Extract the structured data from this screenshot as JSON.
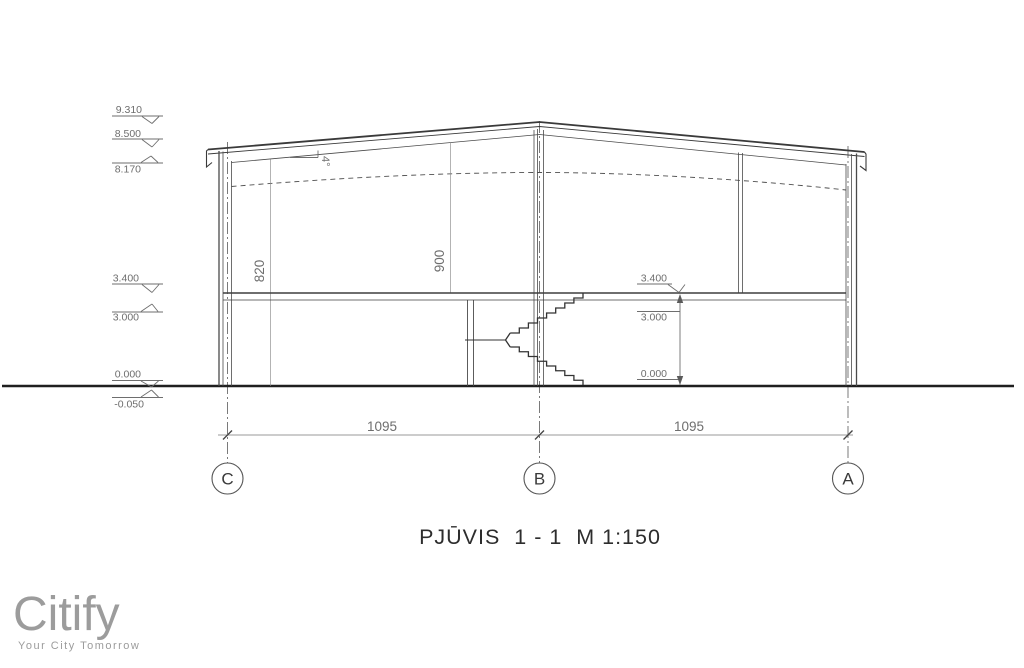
{
  "drawing": {
    "title": "PJŪVIS  1 - 1  M 1:150",
    "left_elevations": {
      "apex": "9.310",
      "eave_top": "8.500",
      "eave_bottom": "8.170",
      "floor_top": "3.400",
      "floor_bottom": "3.000",
      "ground": "0.000",
      "below_ground": "-0.050"
    },
    "right_elevations": {
      "floor_top": "3.400",
      "upper": "3.000",
      "lower": "0.000"
    },
    "member_dims": {
      "left": "820",
      "middle": "900"
    },
    "roof_slope": "4°",
    "span_dims": {
      "cb": "1095",
      "ba": "1095"
    },
    "axes": {
      "left": "C",
      "middle": "B",
      "right": "A"
    }
  },
  "branding": {
    "name": "Citify",
    "tagline": "Your City Tomorrow"
  }
}
